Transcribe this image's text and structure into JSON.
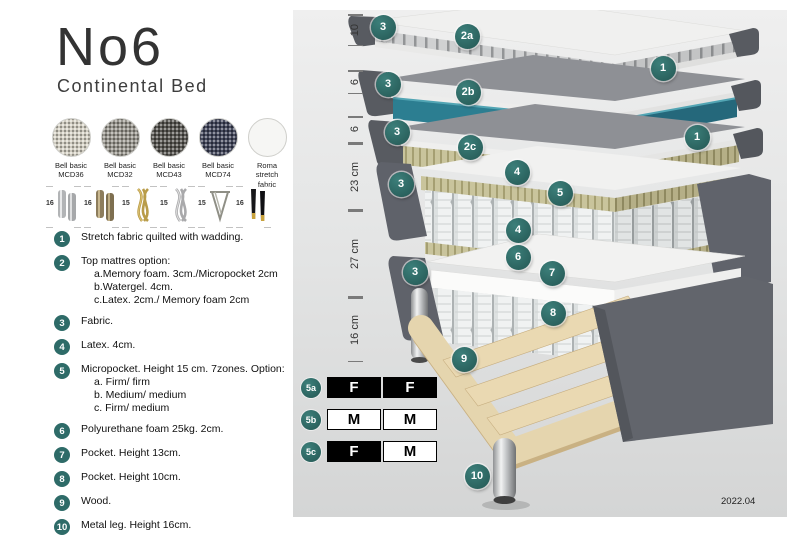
{
  "title": "No6",
  "subtitle": "Continental Bed",
  "colors": {
    "accent_teal": "#2E6B68",
    "watergel_teal": "#2C7E91",
    "latex_khaki": "#C9C49C",
    "wood": "#E5D5AE",
    "fabric_dark_gray": "#5F626A"
  },
  "fabric_swatches": [
    {
      "label_line1": "Bell basic",
      "label_line2": "MCD36",
      "color": "#d9d5c7",
      "texture": "woven"
    },
    {
      "label_line1": "Bell basic",
      "label_line2": "MCD32",
      "color": "#97948c",
      "texture": "woven"
    },
    {
      "label_line1": "Bell basic",
      "label_line2": "MCD43",
      "color": "#504e49",
      "texture": "woven"
    },
    {
      "label_line1": "Bell basic",
      "label_line2": "MCD74",
      "color": "#3a3e54",
      "texture": "woven"
    },
    {
      "label_line1": "Roma",
      "label_line2": "stretch fabric",
      "color": "#f6f6f4",
      "texture": "plain"
    }
  ],
  "leg_options": [
    {
      "height": "16",
      "style": "cylinder-silver"
    },
    {
      "height": "16",
      "style": "cylinder-bronze"
    },
    {
      "height": "15",
      "style": "twisted-gold"
    },
    {
      "height": "15",
      "style": "twisted-silver"
    },
    {
      "height": "15",
      "style": "hairpin"
    },
    {
      "height": "16",
      "style": "black-gold-tip"
    }
  ],
  "legend_items": [
    {
      "num": "1",
      "lines": [
        "Stretch fabric quilted with wadding."
      ]
    },
    {
      "num": "2",
      "lines": [
        "Top mattres option:",
        "a.Memory foam. 3cm./Micropocket 2cm",
        "b.Watergel. 4cm.",
        "c.Latex. 2cm./ Memory foam 2cm"
      ]
    },
    {
      "num": "3",
      "lines": [
        "Fabric."
      ]
    },
    {
      "num": "4",
      "lines": [
        "Latex. 4cm."
      ]
    },
    {
      "num": "5",
      "lines": [
        "Micropocket. Height 15 cm. 7zones. Option:",
        "a. Firm/ firm",
        "b. Medium/ medium",
        "c. Firm/ medium"
      ]
    },
    {
      "num": "6",
      "lines": [
        "Polyurethane foam 25kg. 2cm."
      ]
    },
    {
      "num": "7",
      "lines": [
        "Pocket. Height 13cm."
      ]
    },
    {
      "num": "8",
      "lines": [
        "Pocket. Height 10cm."
      ]
    },
    {
      "num": "9",
      "lines": [
        "Wood."
      ]
    },
    {
      "num": "10",
      "lines": [
        "Metal leg. Height 16cm."
      ]
    }
  ],
  "diagram": {
    "dimensions": [
      {
        "label": "10",
        "from": 4,
        "to": 36
      },
      {
        "label": "6",
        "from": 60,
        "to": 84
      },
      {
        "label": "6",
        "from": 106,
        "to": 133
      },
      {
        "label": "23 cm",
        "from": 133,
        "to": 200
      },
      {
        "label": "27 cm",
        "from": 200,
        "to": 287
      },
      {
        "label": "16 cm",
        "from": 287,
        "to": 352
      }
    ],
    "callouts": [
      {
        "label": "3",
        "x": 90,
        "y": 17
      },
      {
        "label": "2a",
        "x": 174,
        "y": 26
      },
      {
        "label": "1",
        "x": 370,
        "y": 58
      },
      {
        "label": "3",
        "x": 95,
        "y": 74
      },
      {
        "label": "2b",
        "x": 175,
        "y": 82
      },
      {
        "label": "3",
        "x": 104,
        "y": 122
      },
      {
        "label": "2c",
        "x": 177,
        "y": 137
      },
      {
        "label": "1",
        "x": 404,
        "y": 127
      },
      {
        "label": "3",
        "x": 108,
        "y": 174
      },
      {
        "label": "4",
        "x": 224,
        "y": 162
      },
      {
        "label": "5",
        "x": 267,
        "y": 183
      },
      {
        "label": "4",
        "x": 225,
        "y": 220
      },
      {
        "label": "3",
        "x": 122,
        "y": 262
      },
      {
        "label": "6",
        "x": 225,
        "y": 247
      },
      {
        "label": "7",
        "x": 259,
        "y": 263
      },
      {
        "label": "8",
        "x": 260,
        "y": 303
      },
      {
        "label": "9",
        "x": 171,
        "y": 349
      },
      {
        "label": "10",
        "x": 184,
        "y": 466
      }
    ],
    "firmness_table": [
      {
        "row": "5a",
        "cells": [
          {
            "text": "F",
            "filled": true
          },
          {
            "text": "F",
            "filled": true
          }
        ]
      },
      {
        "row": "5b",
        "cells": [
          {
            "text": "M",
            "filled": false
          },
          {
            "text": "M",
            "filled": false
          }
        ]
      },
      {
        "row": "5c",
        "cells": [
          {
            "text": "F",
            "filled": true
          },
          {
            "text": "M",
            "filled": false
          }
        ]
      }
    ],
    "version": "2022.04"
  }
}
